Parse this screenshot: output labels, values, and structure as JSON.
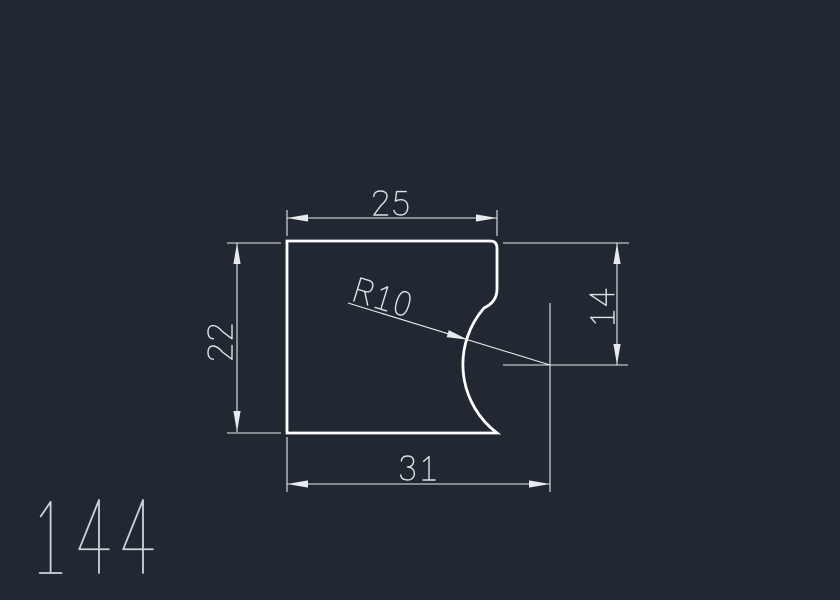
{
  "viewport": {
    "background": "#222831"
  },
  "styles": {
    "outline_color": "#ffffff",
    "dim_color": "#e7ebee",
    "dim_text_color": "#dde3e8",
    "part_number_color": "#ccd3da"
  },
  "drawing": {
    "part_number": "144",
    "dimensions": {
      "top_width": {
        "label": "25"
      },
      "left_height": {
        "label": "22"
      },
      "right_height": {
        "label": "14"
      },
      "bottom_width": {
        "label": "31"
      },
      "radius": {
        "label": "R10"
      }
    }
  }
}
